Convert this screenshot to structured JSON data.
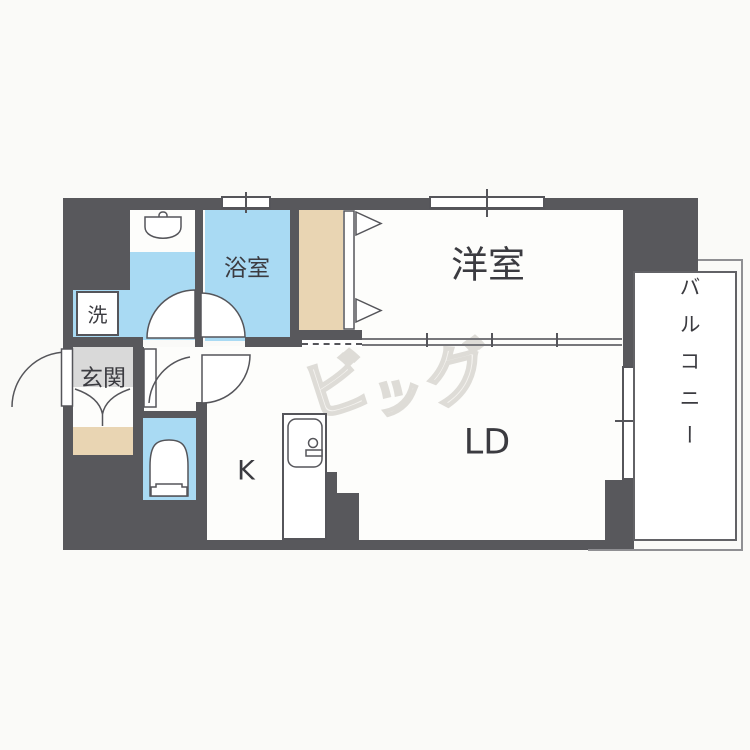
{
  "watermark": "ビッグ",
  "rooms": {
    "bathroom": "浴室",
    "laundry": "洗",
    "entrance": "玄関",
    "western_room": "洋室",
    "kitchen": "K",
    "living_dining": "LD",
    "balcony": "バルコニー"
  },
  "colors": {
    "wall": "#58585c",
    "water_blue": "#a9daf3",
    "closet_tan": "#e9d5b3",
    "entrance_gray": "#d9d9d9",
    "floor_white": "#fdfdfb",
    "background": "#fafaf8",
    "line": "#55555a"
  }
}
